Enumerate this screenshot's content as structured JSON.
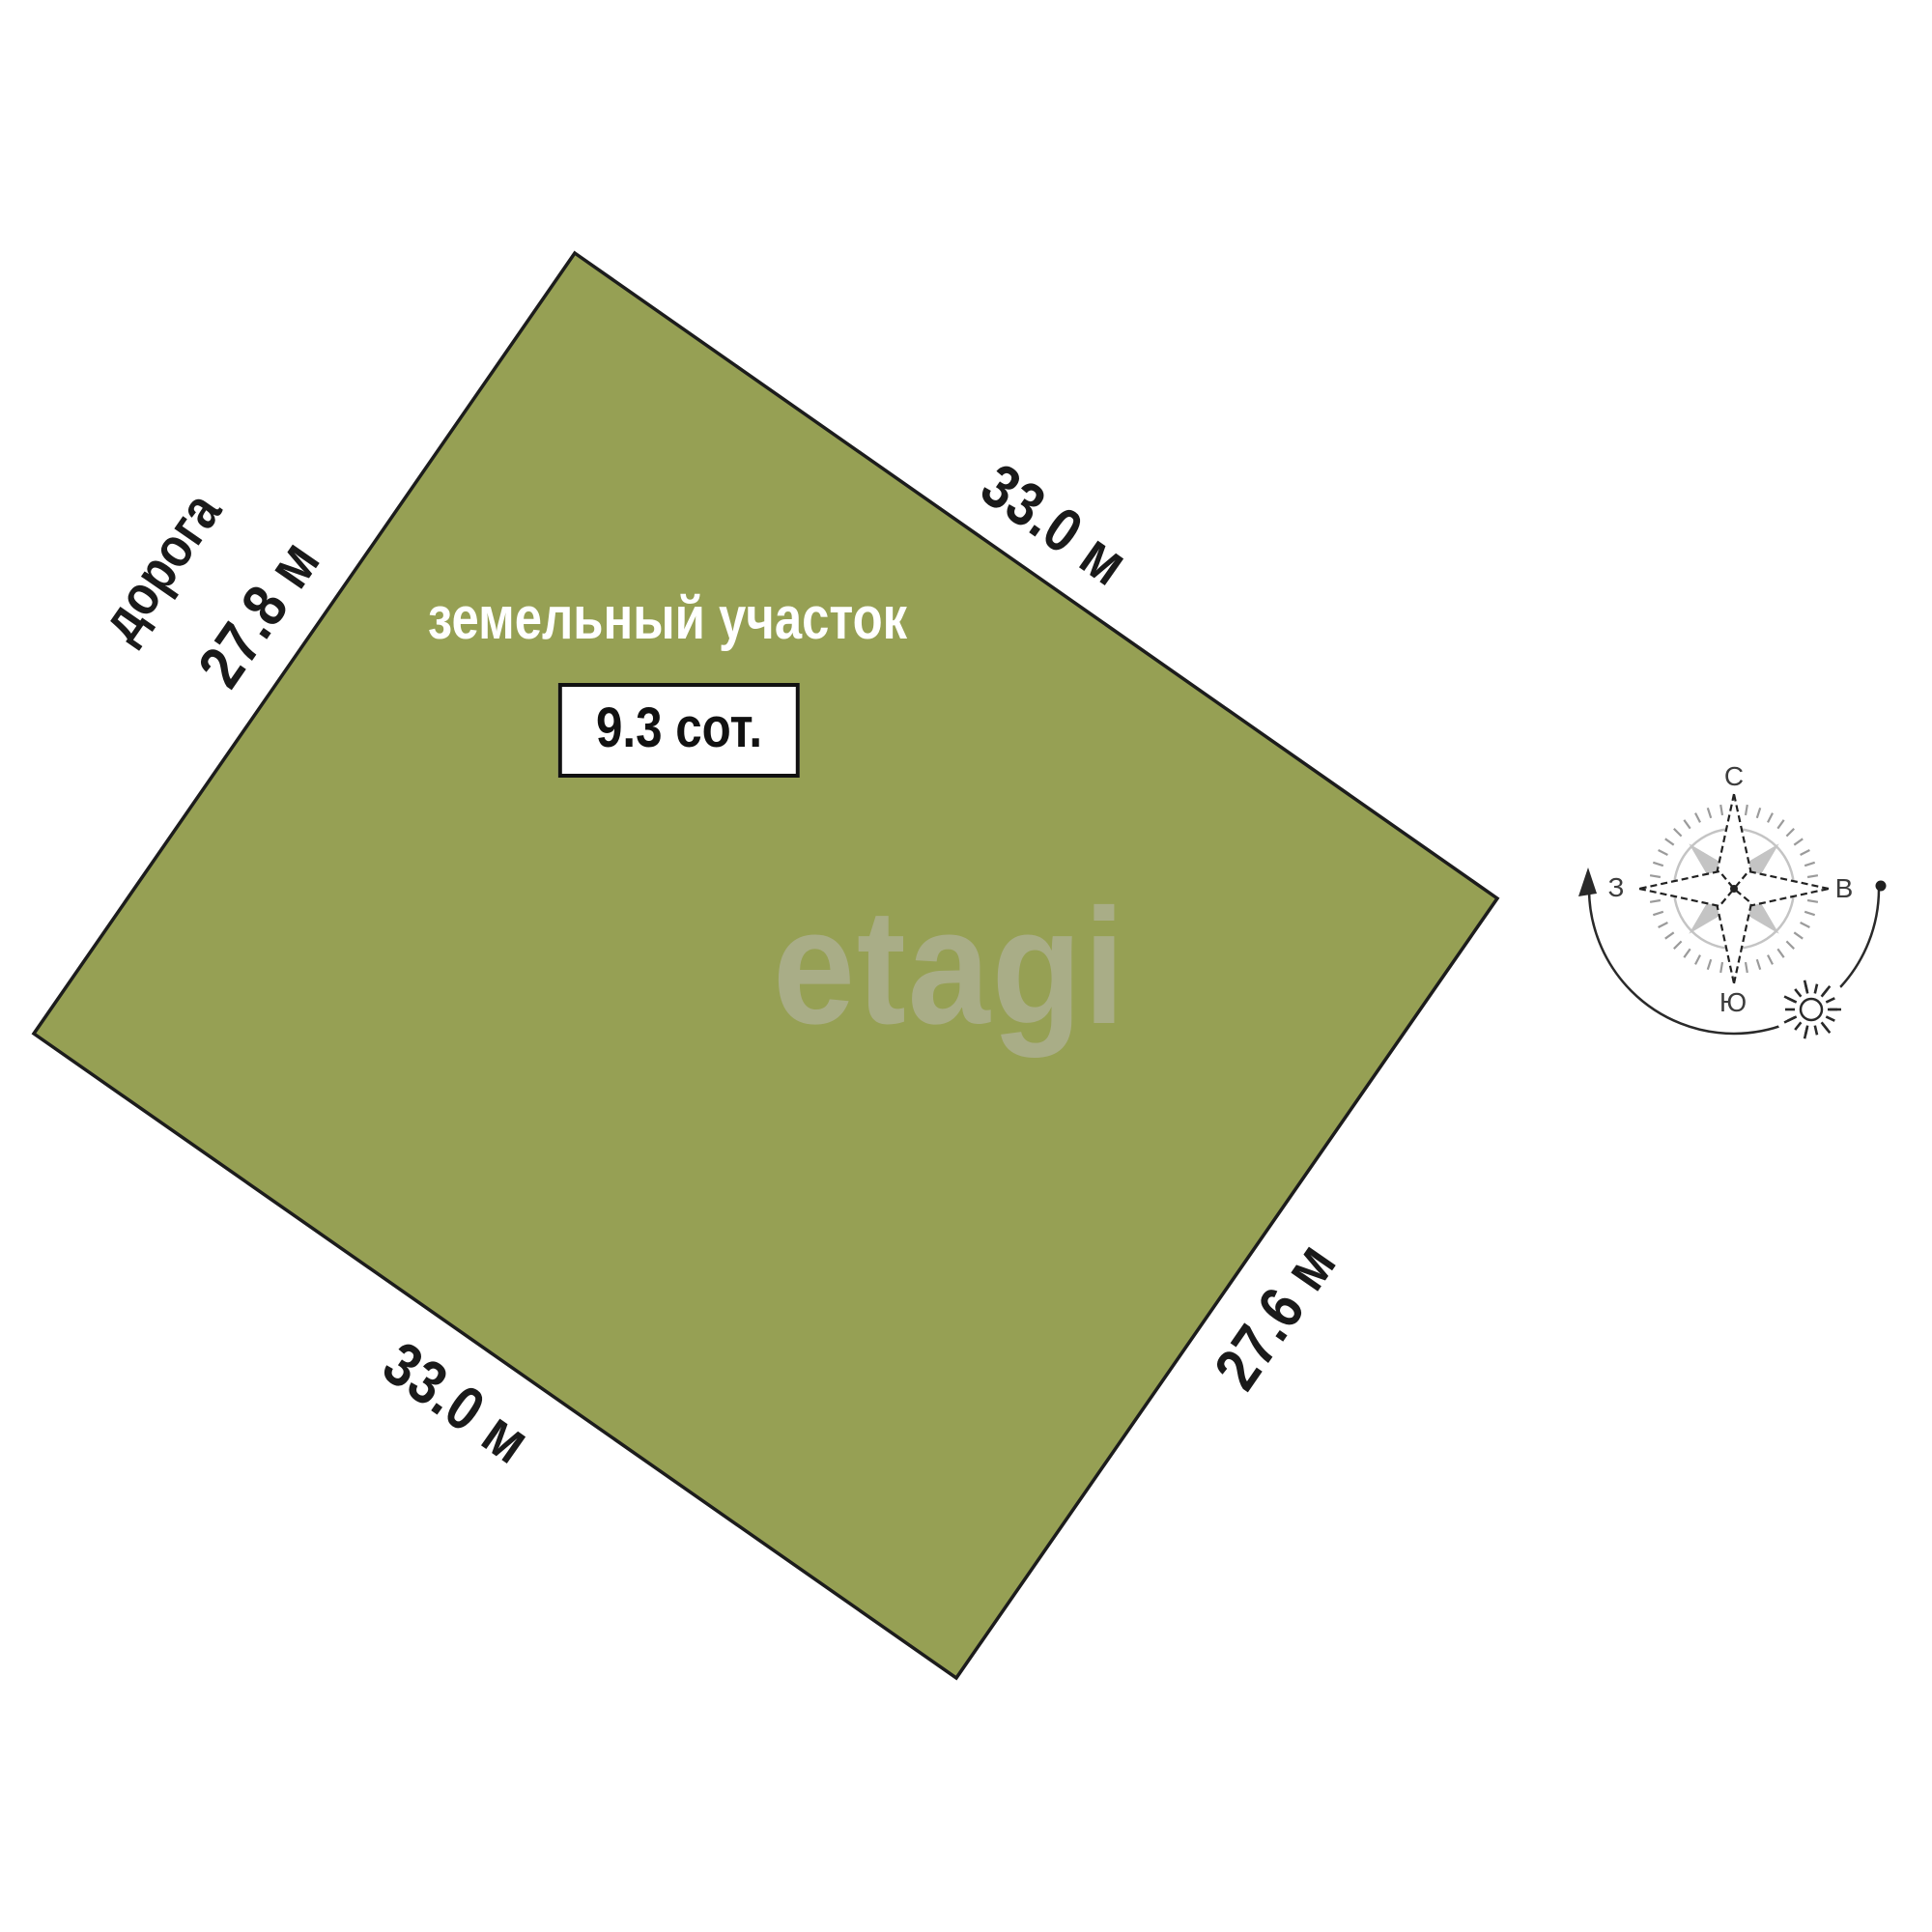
{
  "plot": {
    "name_label": "земельный участок",
    "area_label": "9.3 сот.",
    "fill_color": "#96a054",
    "outline_color": "#1c1c1c"
  },
  "edges": {
    "top_right": "33.0 м",
    "left": "27.8 м",
    "bottom_left": "33.0 м",
    "bottom_right": "27.6 м"
  },
  "road_label": "дорога",
  "watermark": "etagi",
  "compass": {
    "north_label": "С",
    "east_label": "В",
    "south_label": "Ю",
    "west_label": "З",
    "line_color": "#2a2a2a",
    "kite_outline_color": "#222222",
    "gray_fill": "#c4c4c4",
    "ring_color": "#9b9b9b"
  }
}
